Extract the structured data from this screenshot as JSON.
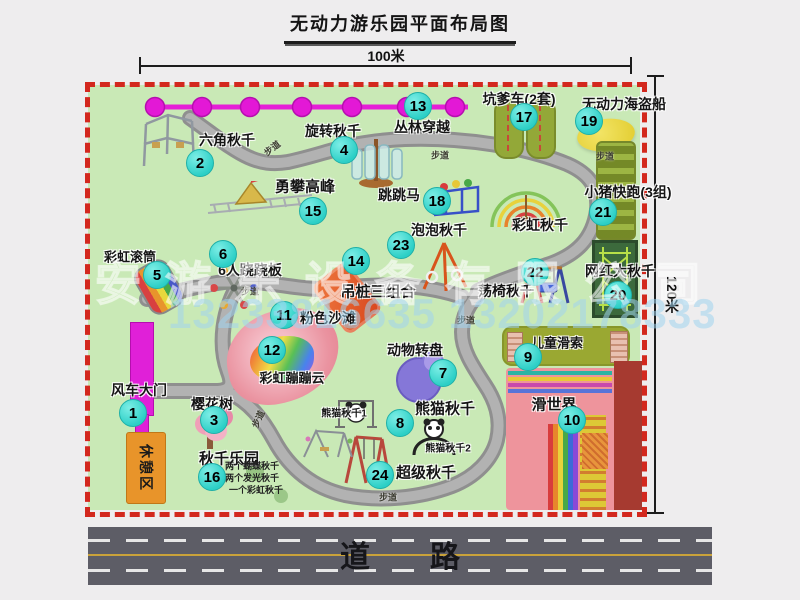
{
  "title": "无动力游乐园平面布局图",
  "dimensions": {
    "width": "100米",
    "height": "120米"
  },
  "watermark": {
    "company": "安游乐设备有限公司",
    "phone": "13233816635 13202178333"
  },
  "road_label": "道　　路",
  "walkway_label": "步道",
  "rest_area_label": "休憩区",
  "unnumbered": {
    "rainbow_swing": "彩虹秋千",
    "panda_swing_1": "熊猫秋千1",
    "panda_swing_2": "熊猫秋千2"
  },
  "swing_park_notes": [
    "两个蝴蝶秋千",
    "两个发光秋千",
    "一个彩虹秋千"
  ],
  "colors": {
    "badge": "#2ccfc6",
    "border_dash": "#d3281e",
    "park_green": "#c9e9b6",
    "magenta": "#e020d8",
    "road_gray": "#5d5d66"
  },
  "attractions": [
    {
      "num": "1",
      "name": "风车大门"
    },
    {
      "num": "2",
      "name": "六角秋千"
    },
    {
      "num": "3",
      "name": "樱花树"
    },
    {
      "num": "4",
      "name": "旋转秋千"
    },
    {
      "num": "5",
      "name": "彩虹滚筒"
    },
    {
      "num": "6",
      "name": "6人跷跷板"
    },
    {
      "num": "7",
      "name": "动物转盘"
    },
    {
      "num": "8",
      "name": "熊猫秋千"
    },
    {
      "num": "9",
      "name": "儿童滑索"
    },
    {
      "num": "10",
      "name": "滑世界"
    },
    {
      "num": "11",
      "name": "粉色沙滩"
    },
    {
      "num": "12",
      "name": "彩虹蹦蹦云"
    },
    {
      "num": "13",
      "name": "丛林穿越"
    },
    {
      "num": "14",
      "name": "吊桩三组合"
    },
    {
      "num": "15",
      "name": "勇攀高峰"
    },
    {
      "num": "16",
      "name": "秋千乐园"
    },
    {
      "num": "17",
      "name": "坑爹车(2套)"
    },
    {
      "num": "18",
      "name": "跳跳马"
    },
    {
      "num": "19",
      "name": "无动力海盗船"
    },
    {
      "num": "20",
      "name": "网红大秋千"
    },
    {
      "num": "21",
      "name": "小猪快跑(3组)"
    },
    {
      "num": "22",
      "name": "荡椅秋千"
    },
    {
      "num": "23",
      "name": "泡泡秋千"
    },
    {
      "num": "24",
      "name": "超级秋千"
    }
  ]
}
